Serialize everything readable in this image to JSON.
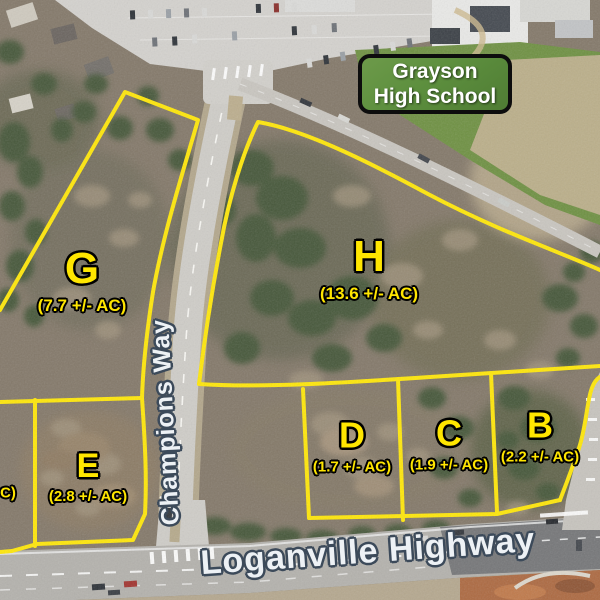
{
  "school_sign": {
    "label": "Grayson High School"
  },
  "road_labels": {
    "champions_way": "Champions Way",
    "loganville_highway": "Loganville Highway"
  },
  "parcels": {
    "G": {
      "id": "G",
      "acreage": "(7.7 +/- AC)"
    },
    "H": {
      "id": "H",
      "acreage": "(13.6 +/- AC)"
    },
    "D": {
      "id": "D",
      "acreage": "(1.7 +/- AC)"
    },
    "C": {
      "id": "C",
      "acreage": "(1.9 +/- AC)"
    },
    "B": {
      "id": "B",
      "acreage": "(2.2 +/- AC)"
    },
    "E": {
      "id": "E",
      "acreage": "(2.8 +/- AC)"
    },
    "partial_left": {
      "acreage_fragment": "C)"
    }
  },
  "colors": {
    "parcel_line": "#ffe70a",
    "label_text": "#ffe600",
    "road_label_fill": "#edf1f5",
    "road_label_outline": "#3c4a5a",
    "sign_green": "#5d8f3e"
  }
}
